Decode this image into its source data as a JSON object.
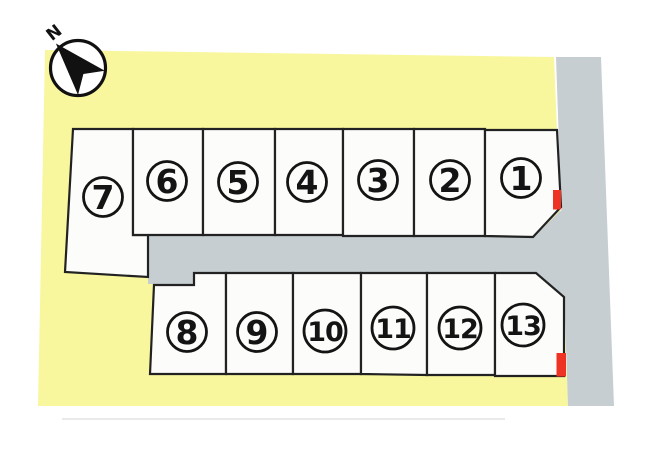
{
  "diagram": {
    "type": "land-lot-site-plan",
    "compass": {
      "label": "N",
      "direction": "northwest-up"
    },
    "lots": [
      {
        "id": "1",
        "label": "1",
        "row": "top",
        "has_red_marker": true
      },
      {
        "id": "2",
        "label": "2",
        "row": "top",
        "has_red_marker": false
      },
      {
        "id": "3",
        "label": "3",
        "row": "top",
        "has_red_marker": false
      },
      {
        "id": "4",
        "label": "4",
        "row": "top",
        "has_red_marker": false
      },
      {
        "id": "5",
        "label": "5",
        "row": "top",
        "has_red_marker": false
      },
      {
        "id": "6",
        "label": "6",
        "row": "top",
        "has_red_marker": false
      },
      {
        "id": "7",
        "label": "7",
        "row": "top",
        "has_red_marker": false
      },
      {
        "id": "8",
        "label": "8",
        "row": "bottom",
        "has_red_marker": false
      },
      {
        "id": "9",
        "label": "9",
        "row": "bottom",
        "has_red_marker": false
      },
      {
        "id": "10",
        "label": "10",
        "row": "bottom",
        "has_red_marker": false
      },
      {
        "id": "11",
        "label": "11",
        "row": "bottom",
        "has_red_marker": false
      },
      {
        "id": "12",
        "label": "12",
        "row": "bottom",
        "has_red_marker": false
      },
      {
        "id": "13",
        "label": "13",
        "row": "bottom",
        "has_red_marker": true
      }
    ],
    "colors": {
      "page": "#ffffff",
      "parcel": "#f8f79e",
      "road": "#c6ced2",
      "lot_fill": "#fcfcfb",
      "lot_border": "#222222",
      "marker_red": "#ee3224",
      "number_ink": "#141414"
    }
  }
}
